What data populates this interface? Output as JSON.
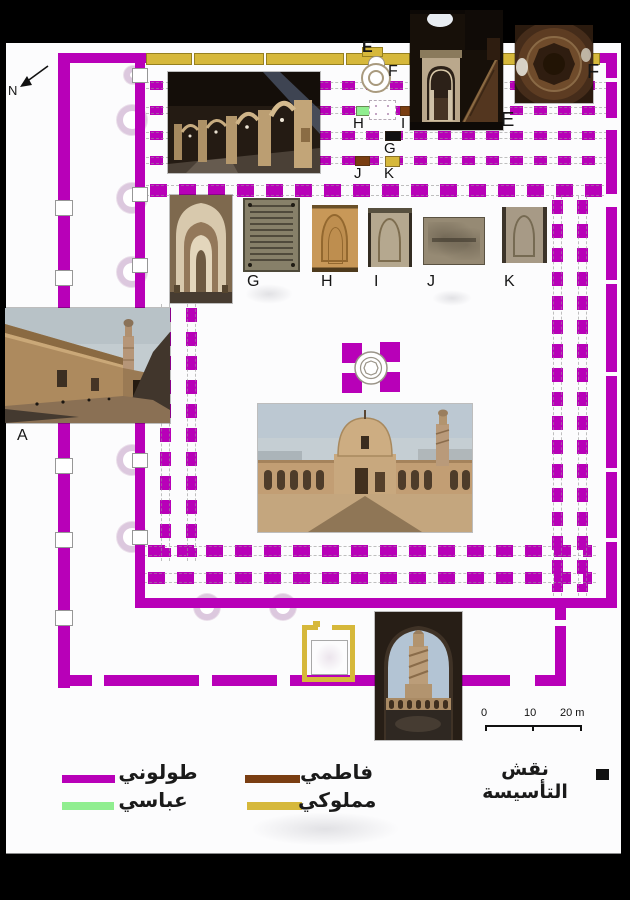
{
  "compass": "N",
  "letters": {
    "a": "A",
    "e": "E",
    "f": "F",
    "g": "G",
    "h": "H",
    "i": "I",
    "j": "J",
    "k": "K"
  },
  "legend": {
    "tulunid": "طولوني",
    "abbasid": "عباسي",
    "fatimid": "فاطمي",
    "mamluk": "مملوكي",
    "foundation": "نقش التأسيسة"
  },
  "colors": {
    "tulunid": "#b800b8",
    "abbasid": "#90ee90",
    "fatimid": "#7a3e12",
    "mamluk": "#d6b83b",
    "foundation": "#111111",
    "faded": "#dcc8de"
  },
  "scale": {
    "t0": "0",
    "t10": "10",
    "t20": "20 m"
  }
}
